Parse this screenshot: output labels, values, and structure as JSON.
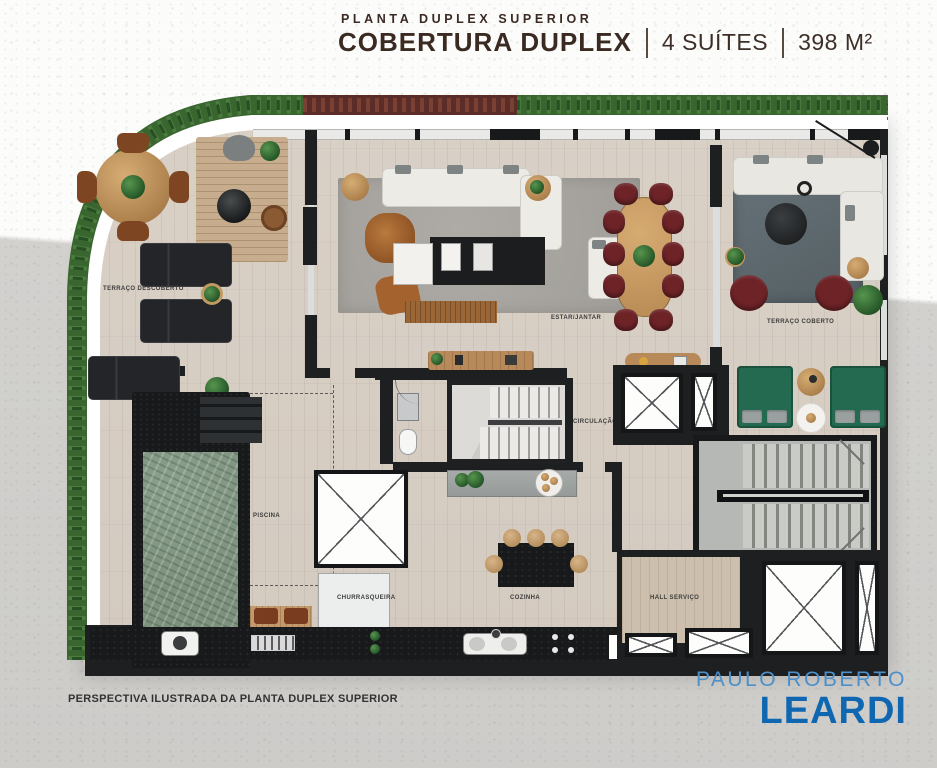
{
  "header": {
    "subtitle": "PLANTA DUPLEX SUPERIOR",
    "title": "COBERTURA DUPLEX",
    "suites": "4 SUÍTES",
    "area": "398 M²"
  },
  "rooms": {
    "terraco_descoberto": "TERRAÇO DESCOBERTO",
    "estar_jantar": "ESTAR/JANTAR",
    "terraco_coberto": "TERRAÇO COBERTO",
    "circulacao": "CIRCULAÇÃO",
    "piscina": "PISCINA",
    "churrasqueira": "CHURRASQUEIRA",
    "cozinha": "COZINHA",
    "hall_servico": "HALL SERVIÇO"
  },
  "footer": {
    "caption": "PERSPECTIVA ILUSTRADA DA PLANTA DUPLEX SUPERIOR",
    "logo_top": "PAULO ROBERTO",
    "logo_bottom": "LEARDI"
  },
  "colors": {
    "title_brown": "#3a2a22",
    "logo_blue": "#4c90ca",
    "logo_blue_dark": "#0f67b1",
    "wall_dark": "#1d1f21",
    "floor_beige": "#d7cec4",
    "pool_green": "#7d917e",
    "hedge_green": "#39652f",
    "hedge_red": "#5b2d28",
    "chair_maroon": "#6e2327",
    "daybed_green": "#236a50",
    "concrete_gray": "#d2d1ce"
  }
}
